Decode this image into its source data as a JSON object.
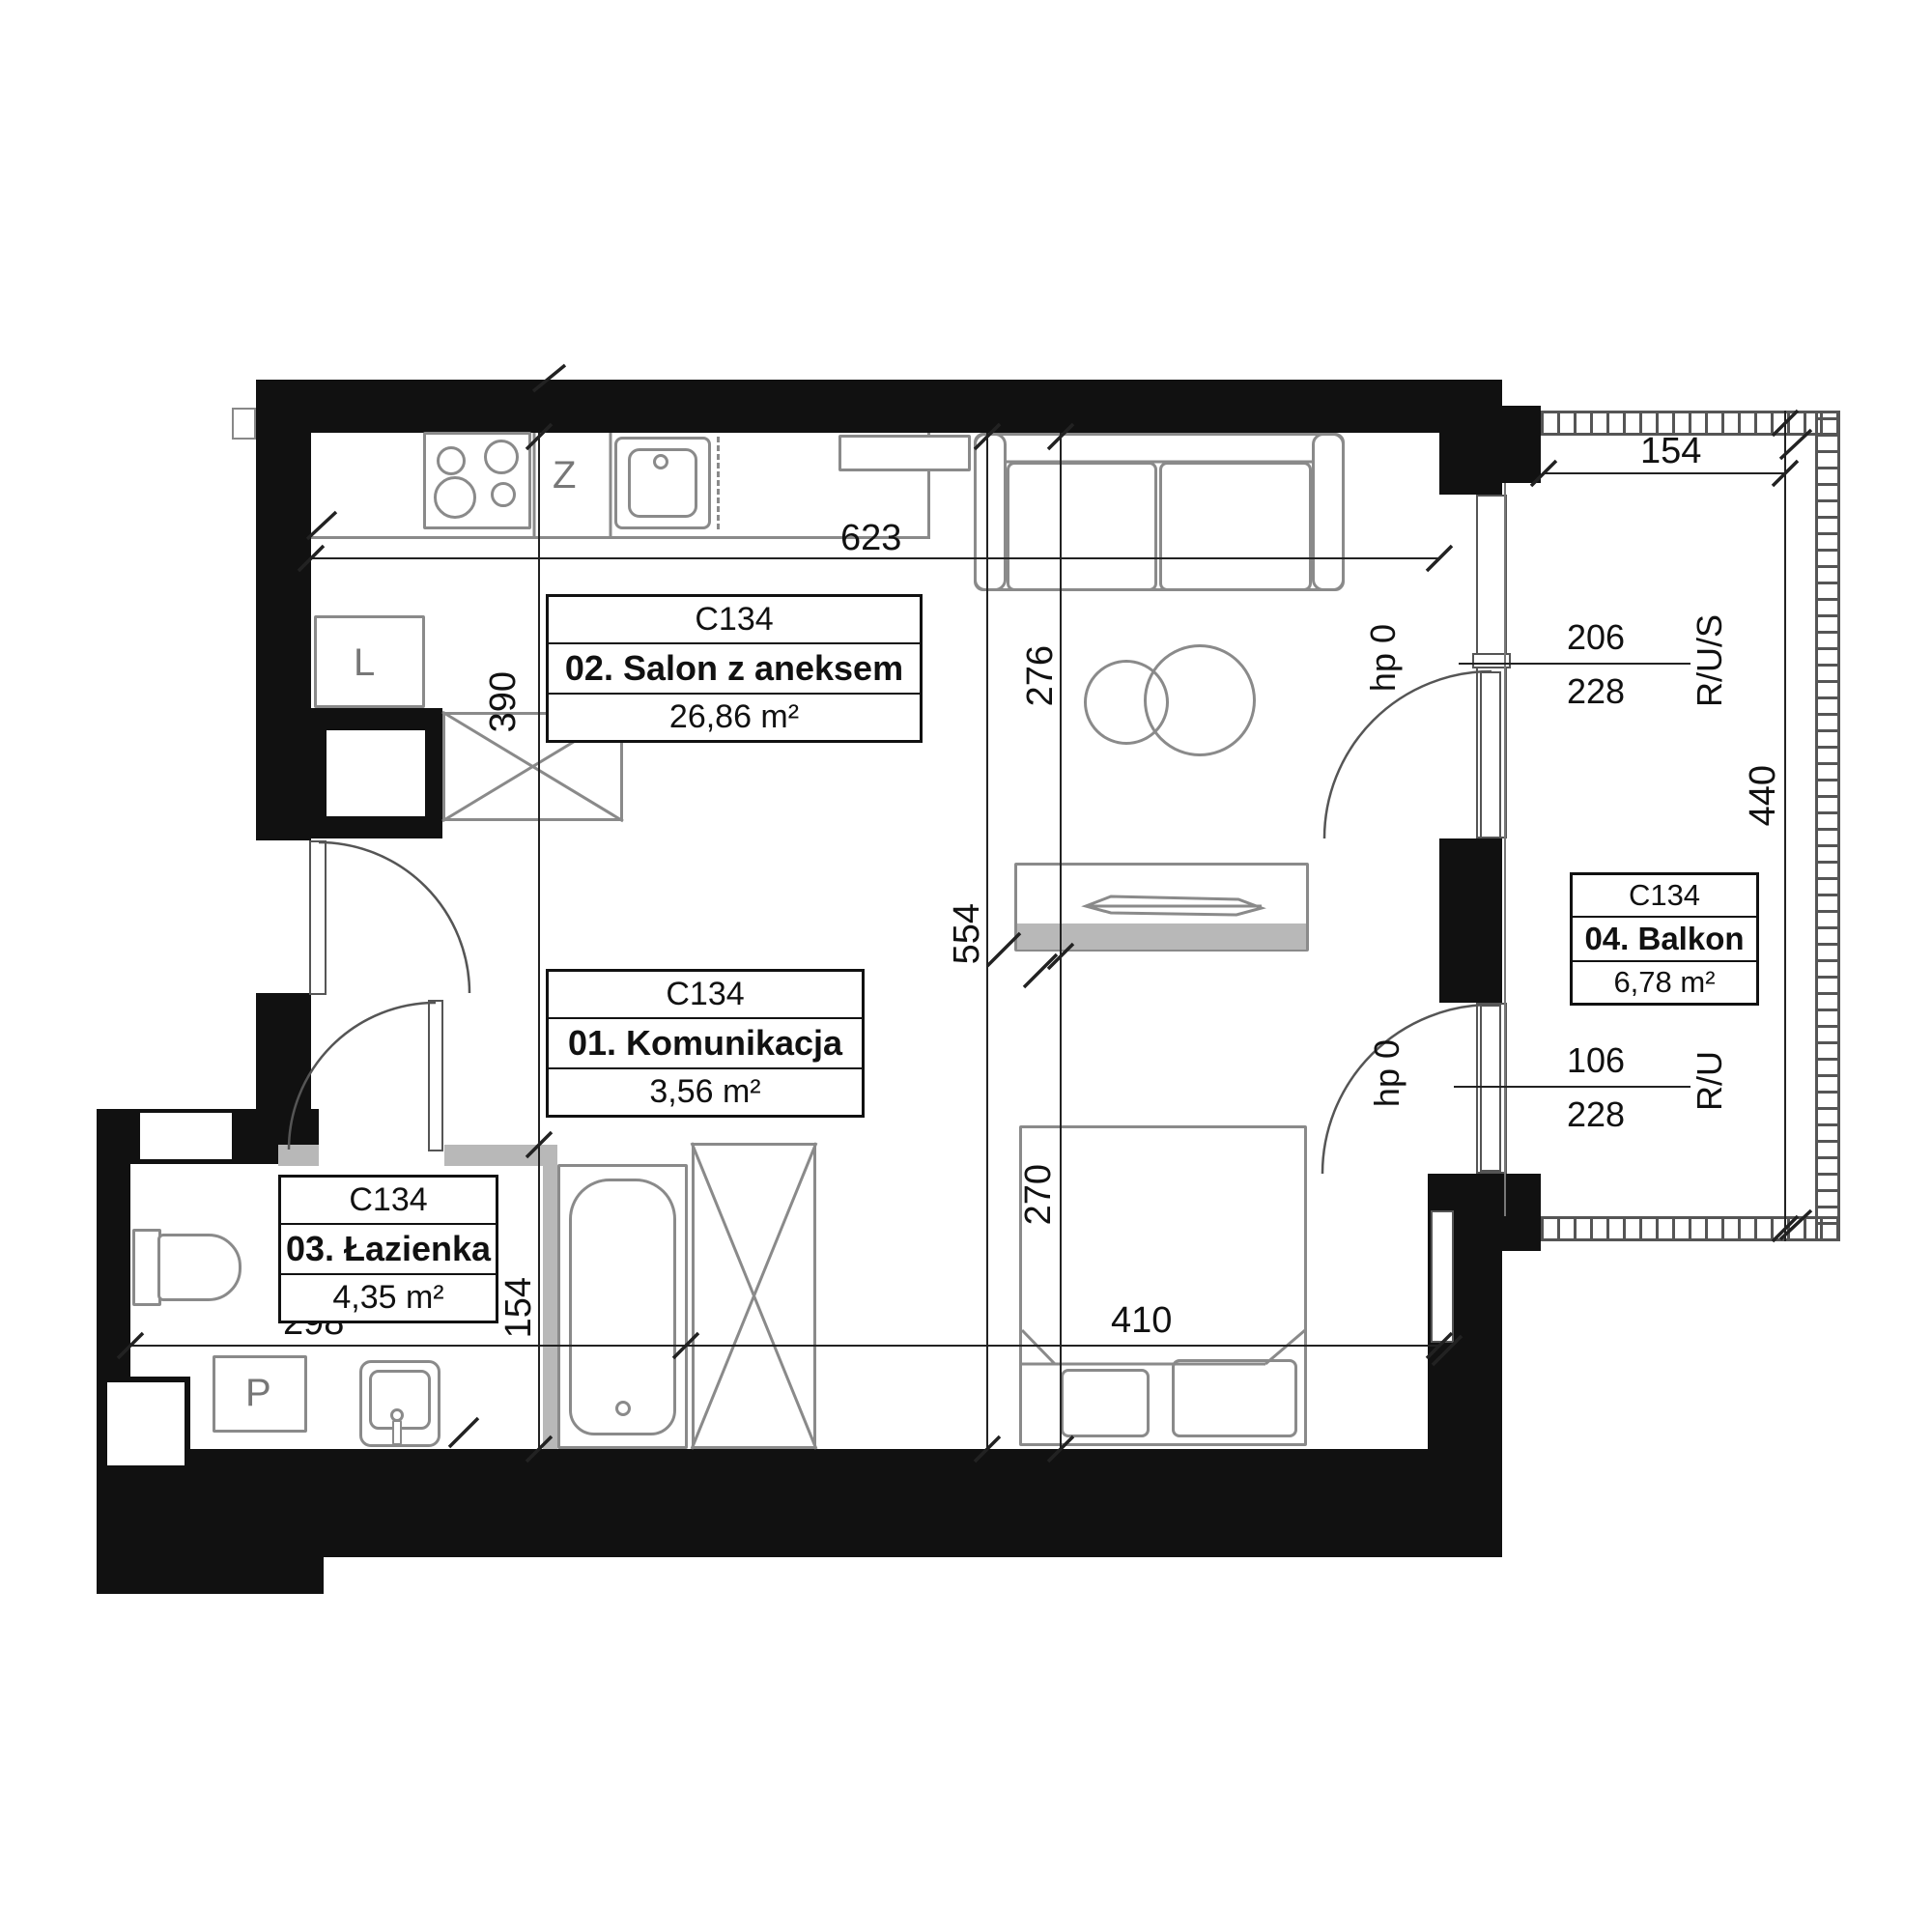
{
  "plan": {
    "unit_code": "C134"
  },
  "rooms": [
    {
      "code": "C134",
      "name": "02. Salon z aneksem",
      "area": "26,86 m²"
    },
    {
      "code": "C134",
      "name": "01. Komunikacja",
      "area": "3,56 m²"
    },
    {
      "code": "C134",
      "name": "03. Łazienka",
      "area": "4,35 m²"
    },
    {
      "code": "C134",
      "name": "04. Balkon",
      "area": "6,78 m²"
    }
  ],
  "dimensions": {
    "salon_width": "623",
    "kitchen_depth": "390",
    "salon_upper": "276",
    "salon_height": "554",
    "bed_zone_depth": "270",
    "bed_zone_width": "410",
    "bathroom_width": "298",
    "bathtub_zone": "154",
    "balcony_top_width": "154",
    "balcony_depth": "440"
  },
  "openings": {
    "upper_window": {
      "width": "206",
      "height": "228",
      "type": "R/U/S",
      "parapet": "hp 0"
    },
    "lower_window": {
      "width": "106",
      "height": "228",
      "type": "R/U",
      "parapet": "hp 0"
    }
  },
  "fixtures": {
    "dishwasher_label": "Z",
    "fridge_label": "L",
    "washing_machine_label": "P"
  },
  "colors": {
    "wall": "#111111",
    "furniture_outline": "#8a8a8a",
    "threshold_gray": "#b8b8b8"
  }
}
